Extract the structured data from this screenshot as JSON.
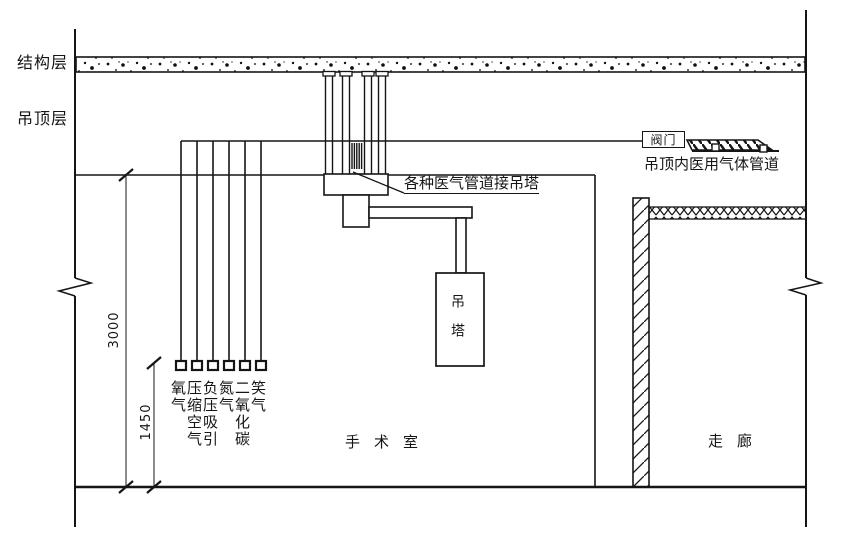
{
  "drawing": {
    "layers": {
      "structural": "结构层",
      "ceiling": "吊顶层"
    },
    "annotations": {
      "pipes_to_pendant": "各种医气管道接吊塔",
      "valve": "阀门",
      "ceiling_gas_pipeline": "吊顶内医用气体管道"
    },
    "equipment": {
      "pendant": "吊塔"
    },
    "rooms": {
      "operating_room": "手术室",
      "corridor": "走廊"
    },
    "dimensions": {
      "room_height": "3000",
      "outlet_height": "1450"
    },
    "gas_outlets": [
      "氧气",
      "压缩空气",
      "负压吸引",
      "氮气",
      "二氧化碳",
      "笑气"
    ],
    "colors": {
      "line": "#151515",
      "background": "#ffffff"
    }
  }
}
